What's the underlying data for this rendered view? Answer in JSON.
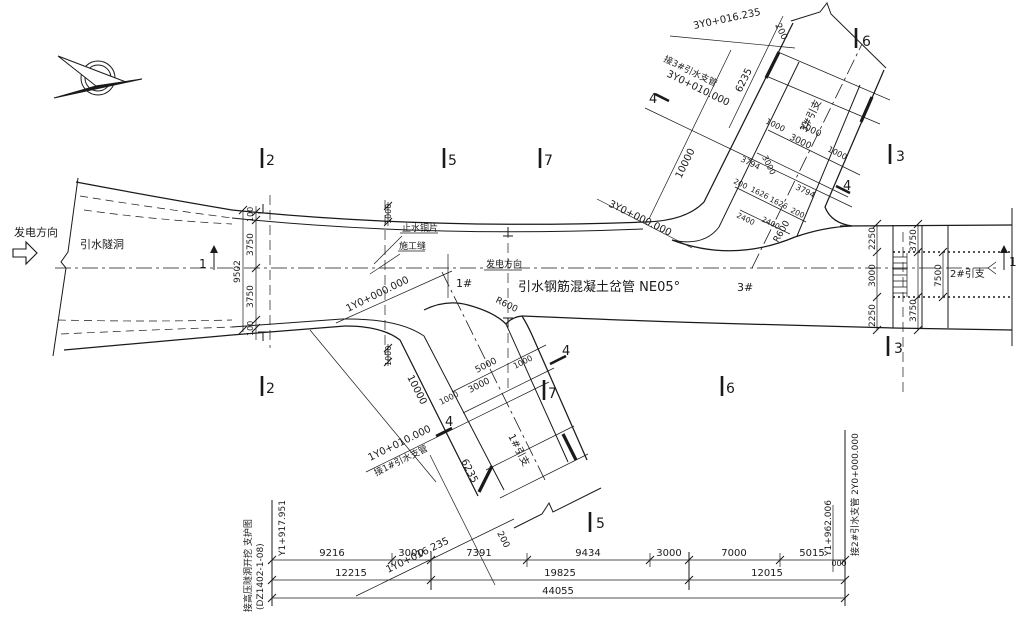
{
  "bg": "#ffffff",
  "ink": "#1a1a1a",
  "title": "引水钢筋混凝土岔管 NE05°",
  "annotations": [
    {
      "name": "flow-direction-left",
      "text": "发电方向",
      "x": 14,
      "y": 236,
      "size": 11
    },
    {
      "name": "tunnel-label",
      "text": "引水隧洞",
      "x": 80,
      "y": 248,
      "size": 11
    },
    {
      "name": "main-title",
      "text": "引水钢筋混凝土岔管  NE05°",
      "x": 518,
      "y": 291,
      "size": 13
    },
    {
      "name": "flow-direction-center",
      "text": "发电方向",
      "x": 486,
      "y": 267,
      "size": 9
    },
    {
      "name": "waterstop-label",
      "text": "止水铜片",
      "x": 402,
      "y": 231,
      "size": 9
    },
    {
      "name": "construction-joint-label",
      "text": "施工缝",
      "x": 399,
      "y": 249,
      "size": 9
    },
    {
      "name": "junction-1-label",
      "text": "1#",
      "x": 456,
      "y": 287,
      "size": 11
    },
    {
      "name": "junction-3-label",
      "text": "3#",
      "x": 737,
      "y": 291,
      "size": 11
    },
    {
      "name": "branch-1-pipe-label",
      "text": "1#引支",
      "x": 508,
      "y": 436,
      "rot": 63,
      "size": 10
    },
    {
      "name": "branch-2-pipe-label",
      "text": "2#引支",
      "x": 950,
      "y": 277,
      "size": 10
    },
    {
      "name": "branch-3-pipe-label",
      "text": "3#引支",
      "x": 806,
      "y": 133,
      "rot": -64,
      "size": 10
    },
    {
      "name": "station-1y0-000000",
      "text": "1Y0+000.000",
      "x": 348,
      "y": 312,
      "rot": -26,
      "size": 10
    },
    {
      "name": "station-1y0-010000",
      "text": "1Y0+010.000",
      "x": 370,
      "y": 461,
      "rot": -26,
      "size": 10
    },
    {
      "name": "connect-branch1-label",
      "text": "接1#引水支管",
      "x": 376,
      "y": 476,
      "rot": -26,
      "size": 9
    },
    {
      "name": "station-1y0-016235",
      "text": "1Y0+016.235",
      "x": 388,
      "y": 573,
      "rot": -26,
      "size": 10
    },
    {
      "name": "dim-200-branch1",
      "text": "200",
      "x": 497,
      "y": 533,
      "rot": 63,
      "size": 9
    },
    {
      "name": "station-3y0-000000",
      "text": "3Y0+000.000",
      "x": 608,
      "y": 206,
      "rot": 26,
      "size": 10
    },
    {
      "name": "connect-branch3-label",
      "text": "接3#引水支管",
      "x": 663,
      "y": 61,
      "rot": 26,
      "size": 9
    },
    {
      "name": "station-3y0-010000",
      "text": "3Y0+010.000",
      "x": 666,
      "y": 76,
      "rot": 26,
      "size": 10
    },
    {
      "name": "station-3y0-016235",
      "text": "3Y0+016.235",
      "x": 694,
      "y": 29,
      "rot": -12,
      "size": 10
    },
    {
      "name": "dim-200-branch3",
      "text": "200",
      "x": 775,
      "y": 25,
      "rot": 64,
      "size": 9
    },
    {
      "name": "dim-10000-branch1",
      "text": "10000",
      "x": 407,
      "y": 377,
      "rot": 63,
      "size": 10
    },
    {
      "name": "dim-6235-branch1",
      "text": "6235",
      "x": 461,
      "y": 461,
      "rot": 63,
      "size": 10
    },
    {
      "name": "dim-5000-branch1",
      "text": "5000",
      "x": 477,
      "y": 373,
      "rot": -27,
      "size": 9
    },
    {
      "name": "dim-3000-branch1",
      "text": "3000",
      "x": 470,
      "y": 393,
      "rot": -27,
      "size": 9
    },
    {
      "name": "dim-1000-branch1-a",
      "text": "1000",
      "x": 441,
      "y": 405,
      "rot": -27,
      "size": 8
    },
    {
      "name": "dim-1000-branch1-b",
      "text": "1000",
      "x": 515,
      "y": 369,
      "rot": -27,
      "size": 8
    },
    {
      "name": "dim-10000-branch3",
      "text": "10000",
      "x": 681,
      "y": 179,
      "rot": -64,
      "size": 10
    },
    {
      "name": "dim-6235-branch3",
      "text": "6235",
      "x": 741,
      "y": 93,
      "rot": -64,
      "size": 10
    },
    {
      "name": "dim-5000-branch3",
      "text": "5000",
      "x": 799,
      "y": 127,
      "rot": 26,
      "size": 9
    },
    {
      "name": "dim-3000-branch3",
      "text": "3000",
      "x": 789,
      "y": 139,
      "rot": 26,
      "size": 9
    },
    {
      "name": "dim-1000-branch3-a",
      "text": "1000",
      "x": 765,
      "y": 123,
      "rot": 26,
      "size": 8
    },
    {
      "name": "dim-1000-branch3-b",
      "text": "1000",
      "x": 827,
      "y": 151,
      "rot": 26,
      "size": 8
    },
    {
      "name": "dim-3794-a",
      "text": "3794",
      "x": 740,
      "y": 161,
      "rot": 26,
      "size": 8
    },
    {
      "name": "dim-3000-bifurcation",
      "text": "3000",
      "x": 762,
      "y": 157,
      "rot": 64,
      "size": 8
    },
    {
      "name": "dim-3794-b",
      "text": "3794",
      "x": 795,
      "y": 189,
      "rot": 26,
      "size": 8
    },
    {
      "name": "dim-200-bif-a",
      "text": "200",
      "x": 733,
      "y": 183,
      "rot": 26,
      "size": 7.5
    },
    {
      "name": "dim-1626-a",
      "text": "1626",
      "x": 750,
      "y": 191,
      "rot": 26,
      "size": 7.5
    },
    {
      "name": "dim-1626-b",
      "text": "1626",
      "x": 769,
      "y": 201,
      "rot": 26,
      "size": 7.5
    },
    {
      "name": "dim-200-bif-b",
      "text": "200",
      "x": 790,
      "y": 212,
      "rot": 26,
      "size": 7.5
    },
    {
      "name": "dim-2400-a",
      "text": "2400",
      "x": 736,
      "y": 217,
      "rot": 26,
      "size": 7.5
    },
    {
      "name": "dim-2400-b",
      "text": "2400",
      "x": 761,
      "y": 221,
      "rot": 26,
      "size": 7.5
    },
    {
      "name": "radius-r600-branch3",
      "text": "R600",
      "x": 778,
      "y": 243,
      "rot": -60,
      "size": 9
    },
    {
      "name": "radius-r600-branch1",
      "text": "R600",
      "x": 495,
      "y": 302,
      "rot": 26,
      "size": 9
    },
    {
      "name": "dim-100-left-top",
      "text": "100",
      "x": 253,
      "y": 222,
      "rot": -90,
      "size": 8
    },
    {
      "name": "dim-3750-left-top",
      "text": "3750",
      "x": 253,
      "y": 256,
      "rot": -90,
      "size": 9
    },
    {
      "name": "dim-3750-left-bottom",
      "text": "3750",
      "x": 253,
      "y": 308,
      "rot": -90,
      "size": 9
    },
    {
      "name": "dim-100-left-bottom",
      "text": "100",
      "x": 253,
      "y": 336,
      "rot": -90,
      "size": 8
    },
    {
      "name": "dim-9502-left",
      "text": "9502",
      "x": 240,
      "y": 283,
      "rot": -90,
      "size": 9
    },
    {
      "name": "dim-1000-mid-top",
      "text": "1000",
      "x": 391,
      "y": 224,
      "rot": -90,
      "size": 8
    },
    {
      "name": "dim-1000-mid-bottom",
      "text": "1000",
      "x": 391,
      "y": 366,
      "rot": -90,
      "size": 8
    },
    {
      "name": "dim-2250-right-top",
      "text": "2250",
      "x": 875,
      "y": 250,
      "rot": -90,
      "size": 9
    },
    {
      "name": "dim-3000-right",
      "text": "3000",
      "x": 875,
      "y": 287,
      "rot": -90,
      "size": 9
    },
    {
      "name": "dim-2250-right-bottom",
      "text": "2250",
      "x": 875,
      "y": 327,
      "rot": -90,
      "size": 9
    },
    {
      "name": "dim-3750-right-top",
      "text": "3750",
      "x": 916,
      "y": 252,
      "rot": -90,
      "size": 9
    },
    {
      "name": "dim-7500-right",
      "text": "7500",
      "x": 941,
      "y": 287,
      "rot": -90,
      "size": 9
    },
    {
      "name": "dim-3750-right-bottom",
      "text": "3750",
      "x": 916,
      "y": 322,
      "rot": -90,
      "size": 9
    },
    {
      "name": "section-2-top",
      "text": "2",
      "x": 266,
      "y": 165,
      "size": 14
    },
    {
      "name": "section-5-top",
      "text": "5",
      "x": 448,
      "y": 165,
      "size": 14
    },
    {
      "name": "section-7-top",
      "text": "7",
      "x": 544,
      "y": 165,
      "size": 14
    },
    {
      "name": "section-6-top-right",
      "text": "6",
      "x": 862,
      "y": 46,
      "size": 14
    },
    {
      "name": "section-3-right-top",
      "text": "3",
      "x": 896,
      "y": 161,
      "size": 14
    },
    {
      "name": "section-3-right-bottom",
      "text": "3",
      "x": 894,
      "y": 353,
      "size": 14
    },
    {
      "name": "section-2-bottom",
      "text": "2",
      "x": 266,
      "y": 393,
      "size": 14
    },
    {
      "name": "section-7-bottom",
      "text": "7",
      "x": 548,
      "y": 398,
      "size": 14
    },
    {
      "name": "section-6-bottom",
      "text": "6",
      "x": 726,
      "y": 393,
      "size": 14
    },
    {
      "name": "section-5-bottom",
      "text": "5",
      "x": 596,
      "y": 528,
      "size": 14
    },
    {
      "name": "section-4-branch3-left",
      "text": "4",
      "x": 649,
      "y": 103,
      "size": 13
    },
    {
      "name": "section-4-branch3-right",
      "text": "4",
      "x": 843,
      "y": 190,
      "size": 13
    },
    {
      "name": "section-4-branch1-left",
      "text": "4",
      "x": 445,
      "y": 426,
      "size": 13
    },
    {
      "name": "section-4-branch1-right",
      "text": "4",
      "x": 562,
      "y": 355,
      "size": 13
    },
    {
      "name": "section-1-left",
      "text": "1",
      "x": 199,
      "y": 268,
      "size": 12
    },
    {
      "name": "section-1-right",
      "text": "1",
      "x": 1009,
      "y": 266,
      "size": 12
    },
    {
      "name": "dim-9216",
      "text": "9216",
      "x": 332,
      "y": 556,
      "size": 10,
      "anchor": "middle"
    },
    {
      "name": "dim-3000-chain-a",
      "text": "3000",
      "x": 411,
      "y": 556,
      "size": 10,
      "anchor": "middle"
    },
    {
      "name": "dim-7391",
      "text": "7391",
      "x": 479,
      "y": 556,
      "size": 10,
      "anchor": "middle"
    },
    {
      "name": "dim-9434",
      "text": "9434",
      "x": 588,
      "y": 556,
      "size": 10,
      "anchor": "middle"
    },
    {
      "name": "dim-3000-chain-b",
      "text": "3000",
      "x": 669,
      "y": 556,
      "size": 10,
      "anchor": "middle"
    },
    {
      "name": "dim-7000",
      "text": "7000",
      "x": 734,
      "y": 556,
      "size": 10,
      "anchor": "middle"
    },
    {
      "name": "dim-5015",
      "text": "5015",
      "x": 812,
      "y": 556,
      "size": 10,
      "anchor": "middle"
    },
    {
      "name": "dim-12215",
      "text": "12215",
      "x": 351,
      "y": 576,
      "size": 10,
      "anchor": "middle"
    },
    {
      "name": "dim-19825",
      "text": "19825",
      "x": 560,
      "y": 576,
      "size": 10,
      "anchor": "middle"
    },
    {
      "name": "dim-12015",
      "text": "12015",
      "x": 767,
      "y": 576,
      "size": 10,
      "anchor": "middle"
    },
    {
      "name": "dim-44055",
      "text": "44055",
      "x": 558,
      "y": 594,
      "size": 10,
      "anchor": "middle"
    },
    {
      "name": "dim-000-right",
      "text": "000",
      "x": 839,
      "y": 566,
      "size": 8,
      "anchor": "middle"
    },
    {
      "name": "ref-drawing-line1",
      "text": "接高压隧洞开挖 支护图",
      "x": 251,
      "y": 612,
      "rot": -90,
      "size": 9
    },
    {
      "name": "ref-drawing-line2",
      "text": "(DZ1402-1-08)",
      "x": 263,
      "y": 610,
      "rot": -90,
      "size": 9
    },
    {
      "name": "elevation-left",
      "text": "Y1+917.951",
      "x": 285,
      "y": 556,
      "rot": -90,
      "size": 9
    },
    {
      "name": "elevation-right",
      "text": "Y1+962.006",
      "x": 831,
      "y": 556,
      "rot": -90,
      "size": 9
    },
    {
      "name": "connect-branch2-label",
      "text": "接2#引水支管 2Y0+000.000",
      "x": 858,
      "y": 556,
      "rot": -90,
      "size": 9
    }
  ]
}
